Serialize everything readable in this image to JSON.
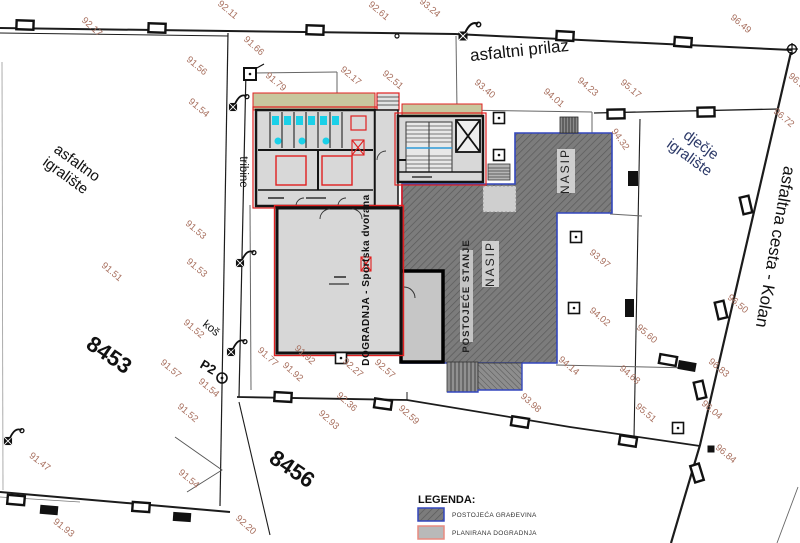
{
  "roads": {
    "north_road": "asfaltni prilaz",
    "east_road": "asfaltna cesta - Kolan"
  },
  "areas": {
    "asfaltno_igraliste_l1": "asfaltno",
    "asfaltno_igraliste_l2": "igralište",
    "djecje_igraliste_l1": "dječje",
    "djecje_igraliste_l2": "igralište",
    "tribine": "tribine",
    "kos": "koš",
    "p2": "P2",
    "parcel_8453": "8453",
    "parcel_8456": "8456",
    "nasip": "NASIP",
    "postojece_stanje": "POSTOJEĆE STANJE",
    "dogradnja": "DOGRADNJA - Sportska dvorana"
  },
  "legend": {
    "title": "LEGENDA:",
    "items": [
      {
        "label": "POSTOJEĆA GRAĐEVINA",
        "swatch_fill": "hatched-dark-gray",
        "swatch_border": "#3347bd"
      },
      {
        "label": "PLANIRANA DOGRADNJA",
        "swatch_fill": "#b9b9b9",
        "swatch_border": "#e98b80"
      }
    ]
  },
  "spot_elevations": [
    {
      "v": "92.17",
      "x": 90,
      "y": 29,
      "r": 42
    },
    {
      "v": "92.11",
      "x": 226,
      "y": 12,
      "r": 40
    },
    {
      "v": "92.61",
      "x": 377,
      "y": 13,
      "r": 40
    },
    {
      "v": "93.24",
      "x": 428,
      "y": 10,
      "r": 40
    },
    {
      "v": "96.49",
      "x": 739,
      "y": 26,
      "r": 40
    },
    {
      "v": "91.66",
      "x": 252,
      "y": 48,
      "r": 42
    },
    {
      "v": "91.56",
      "x": 195,
      "y": 68,
      "r": 40
    },
    {
      "v": "91.79",
      "x": 274,
      "y": 84,
      "r": 40
    },
    {
      "v": "92.17",
      "x": 349,
      "y": 78,
      "r": 40
    },
    {
      "v": "92.51",
      "x": 391,
      "y": 82,
      "r": 40
    },
    {
      "v": "93.40",
      "x": 483,
      "y": 91,
      "r": 40
    },
    {
      "v": "94.01",
      "x": 552,
      "y": 100,
      "r": 40
    },
    {
      "v": "94.23",
      "x": 586,
      "y": 89,
      "r": 40
    },
    {
      "v": "95.17",
      "x": 629,
      "y": 91,
      "r": 40
    },
    {
      "v": "96.9",
      "x": 795,
      "y": 83,
      "r": 40
    },
    {
      "v": "96.72",
      "x": 782,
      "y": 120,
      "r": 40
    },
    {
      "v": "91.54",
      "x": 197,
      "y": 110,
      "r": 40
    },
    {
      "v": "94.32",
      "x": 618,
      "y": 141,
      "r": 55
    },
    {
      "v": "91.53",
      "x": 194,
      "y": 232,
      "r": 40
    },
    {
      "v": "91.53",
      "x": 195,
      "y": 270,
      "r": 40
    },
    {
      "v": "91.51",
      "x": 110,
      "y": 274,
      "r": 40
    },
    {
      "v": "91.52",
      "x": 192,
      "y": 331,
      "r": 40
    },
    {
      "v": "91.57",
      "x": 169,
      "y": 371,
      "r": 40
    },
    {
      "v": "91.54",
      "x": 207,
      "y": 390,
      "r": 40
    },
    {
      "v": "91.52",
      "x": 186,
      "y": 415,
      "r": 40
    },
    {
      "v": "91.47",
      "x": 38,
      "y": 464,
      "r": 38
    },
    {
      "v": "91.54",
      "x": 187,
      "y": 481,
      "r": 40
    },
    {
      "v": "91.93",
      "x": 62,
      "y": 530,
      "r": 38
    },
    {
      "v": "92.20",
      "x": 244,
      "y": 527,
      "r": 42
    },
    {
      "v": "91.77",
      "x": 266,
      "y": 359,
      "r": 42
    },
    {
      "v": "91.92",
      "x": 303,
      "y": 357,
      "r": 42
    },
    {
      "v": "91.92",
      "x": 291,
      "y": 374,
      "r": 42
    },
    {
      "v": "92.27",
      "x": 351,
      "y": 370,
      "r": 42
    },
    {
      "v": "92.57",
      "x": 383,
      "y": 371,
      "r": 42
    },
    {
      "v": "92.36",
      "x": 345,
      "y": 404,
      "r": 42
    },
    {
      "v": "92.93",
      "x": 327,
      "y": 422,
      "r": 42
    },
    {
      "v": "92.59",
      "x": 407,
      "y": 417,
      "r": 42
    },
    {
      "v": "93.98",
      "x": 529,
      "y": 405,
      "r": 42
    },
    {
      "v": "93.97",
      "x": 598,
      "y": 261,
      "r": 40
    },
    {
      "v": "94.02",
      "x": 598,
      "y": 319,
      "r": 40
    },
    {
      "v": "94.14",
      "x": 567,
      "y": 368,
      "r": 40
    },
    {
      "v": "94.68",
      "x": 628,
      "y": 377,
      "r": 40
    },
    {
      "v": "95.60",
      "x": 645,
      "y": 336,
      "r": 40
    },
    {
      "v": "95.51",
      "x": 644,
      "y": 415,
      "r": 40
    },
    {
      "v": "96.04",
      "x": 710,
      "y": 412,
      "r": 40
    },
    {
      "v": "96.83",
      "x": 717,
      "y": 370,
      "r": 40
    },
    {
      "v": "96.50",
      "x": 736,
      "y": 306,
      "r": 40
    },
    {
      "v": "96.84",
      "x": 724,
      "y": 456,
      "r": 40
    }
  ],
  "colors": {
    "spot_label": "#a8705f",
    "existing_hatch_fill": "#7c7c7c",
    "existing_hatch_line": "#5a5a5a",
    "existing_border_blue": "#3347bd",
    "planned_outline_red": "#e02020",
    "planned_fill_gray": "#d8d8d8",
    "terrace_olive": "#c8c79e",
    "sanitary_cyan": "#1ad0e8",
    "djecje_text_blue": "#2c3968",
    "boundary_black": "#1c1c1c"
  }
}
